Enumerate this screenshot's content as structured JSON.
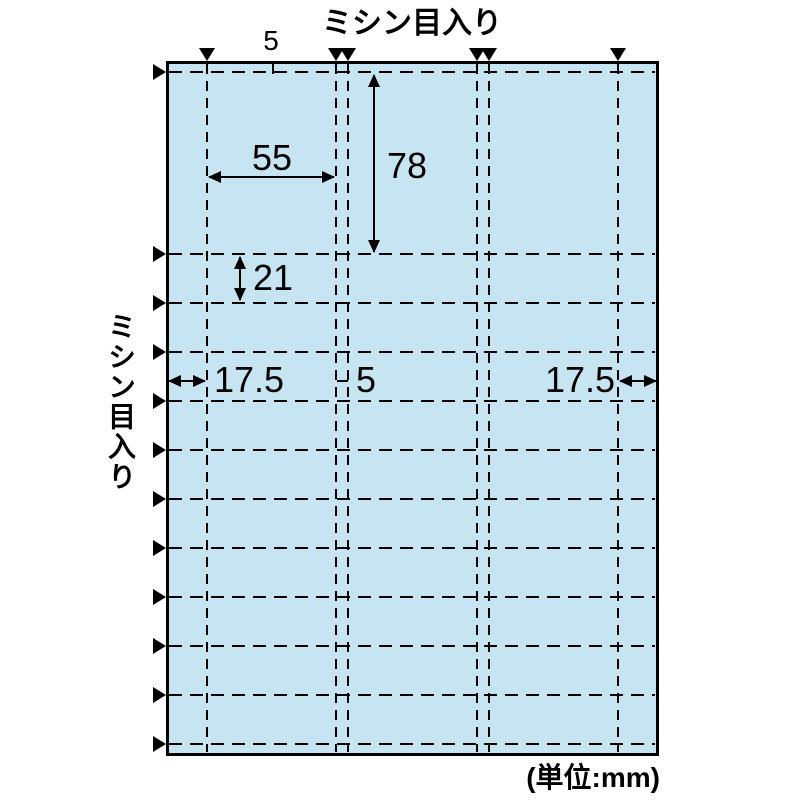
{
  "diagram": {
    "top_perforation_label": "ミシン目入り",
    "left_perforation_label": "ミシン目入り",
    "unit_note": "(単位:mm)",
    "dims": {
      "top_margin_mm": "5",
      "card_width_mm": "55",
      "first_section_height_mm": "78",
      "row_height_mm": "21",
      "left_margin_mm": "17.5",
      "gutter_mm": "5",
      "right_margin_mm": "17.5"
    },
    "colors": {
      "sheet_fill": "#c7e4f2",
      "line": "#000000",
      "background": "#ffffff"
    }
  }
}
